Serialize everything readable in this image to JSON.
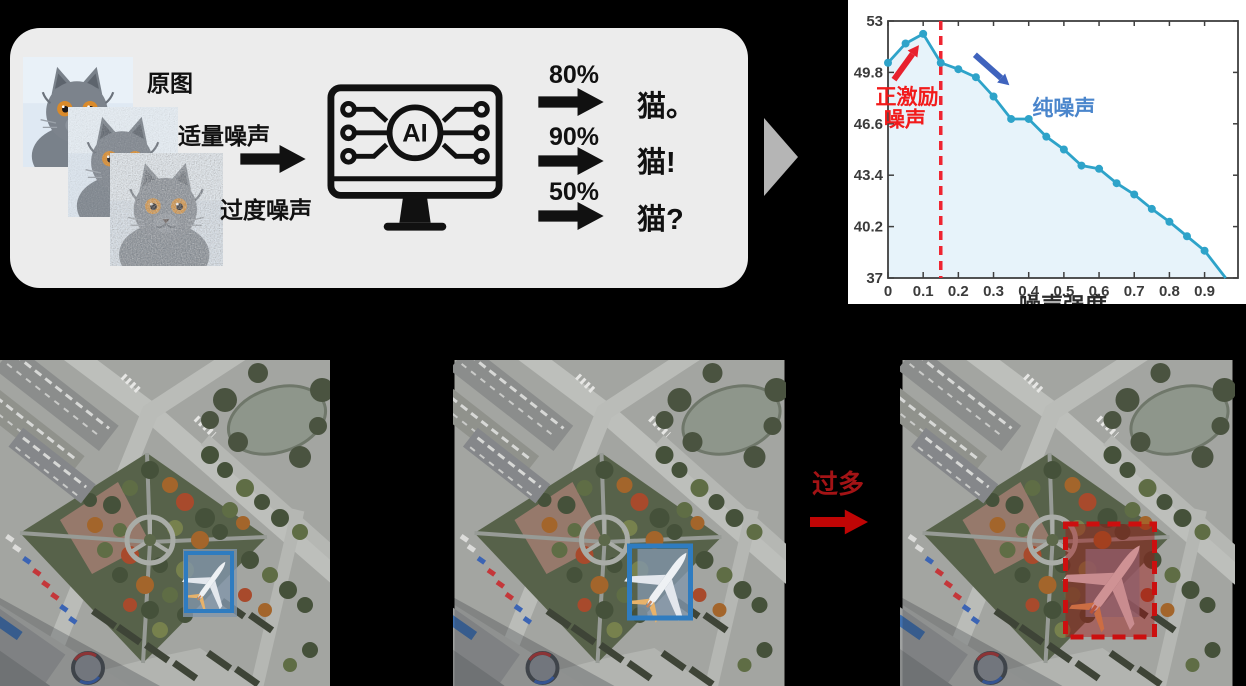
{
  "top_panel": {
    "cats": [
      {
        "label": "原图",
        "noise": 0
      },
      {
        "label": "适量噪声",
        "noise": 0.38
      },
      {
        "label": "过度噪声",
        "noise": 0.88
      }
    ],
    "ai_label": "AI",
    "outputs": [
      {
        "confidence": "80%",
        "label": "猫。"
      },
      {
        "confidence": "90%",
        "label": "猫!"
      },
      {
        "confidence": "50%",
        "label": "猫?"
      }
    ]
  },
  "chart_data": {
    "type": "line",
    "x": [
      0,
      0.05,
      0.1,
      0.15,
      0.2,
      0.25,
      0.3,
      0.35,
      0.4,
      0.45,
      0.5,
      0.55,
      0.6,
      0.65,
      0.7,
      0.75,
      0.8,
      0.85,
      0.9,
      0.96
    ],
    "y": [
      50.4,
      51.6,
      52.2,
      50.4,
      50.0,
      49.5,
      48.3,
      46.9,
      46.9,
      45.8,
      45.0,
      44.0,
      43.8,
      42.9,
      42.2,
      41.3,
      40.5,
      39.6,
      38.7,
      37.0
    ],
    "xlabel": "噪声强度",
    "xlim": [
      0,
      0.995
    ],
    "ylim": [
      37,
      53
    ],
    "xticks": [
      0,
      0.1,
      0.2,
      0.3,
      0.4,
      0.5,
      0.6,
      0.7,
      0.8,
      0.9
    ],
    "xtick_labels": [
      "0",
      "0.1",
      "0.2",
      "0.3",
      "0.4",
      "0.5",
      "0.6",
      "0.7",
      "0.8",
      "0.9"
    ],
    "yticks": [
      37,
      40.2,
      43.4,
      46.6,
      49.8,
      53
    ],
    "ytick_labels": [
      "37",
      "40.2",
      "43.4",
      "46.6",
      "49.8",
      "53"
    ],
    "grid": false,
    "line_color": "#2ea3c9",
    "fill_color": "#e7f3fa",
    "marker": "circle",
    "vline": {
      "x": 0.15,
      "color": "#ef2430",
      "style": "dashed"
    },
    "annotations": [
      {
        "text": "正激励",
        "x": 0.054,
        "y": 48.3,
        "color": "#f21b1b",
        "size": 21
      },
      {
        "text": "噪声",
        "x": 0.048,
        "y": 46.9,
        "color": "#f21b1b",
        "size": 21
      },
      {
        "text": "纯噪声",
        "x": 0.5,
        "y": 47.6,
        "color": "#4b86cc",
        "size": 21
      }
    ],
    "arrows": [
      {
        "x1": 0.017,
        "y1": 49.35,
        "x2": 0.088,
        "y2": 51.5,
        "color": "#e8212e"
      },
      {
        "x1": 0.247,
        "y1": 50.9,
        "x2": 0.345,
        "y2": 49.0,
        "color": "#3f63bd"
      }
    ]
  },
  "bottom": {
    "transition_label": "过多",
    "images": [
      {
        "left": 0,
        "width": 330,
        "bbox": {
          "x": 186,
          "y": 193,
          "w": 46,
          "h": 58,
          "style": "solid",
          "color": "#2f7cc0",
          "fill": "none",
          "stroke_w": 4
        },
        "plane_size": 46
      },
      {
        "left": 453,
        "width": 333,
        "bbox": {
          "x": 175,
          "y": 186,
          "w": 61,
          "h": 72,
          "style": "solid",
          "color": "#2f7cc0",
          "fill": "none",
          "stroke_w": 5
        },
        "plane_size": 66
      },
      {
        "left": 900,
        "width": 335,
        "bbox": {
          "x": 163,
          "y": 164,
          "w": 89,
          "h": 113,
          "style": "dashed",
          "color": "#cc0f0f",
          "fill": "rgba(165,15,15,0.42)",
          "stroke_w": 5
        },
        "plane_size": 82
      }
    ]
  },
  "colors": {
    "panel_bg": "#ececec",
    "page_bg": "#000000",
    "gray_arrow": "#b5b5b5",
    "black_ink": "#111111",
    "red_label": "#a31315",
    "red_arrow": "#c00505"
  }
}
